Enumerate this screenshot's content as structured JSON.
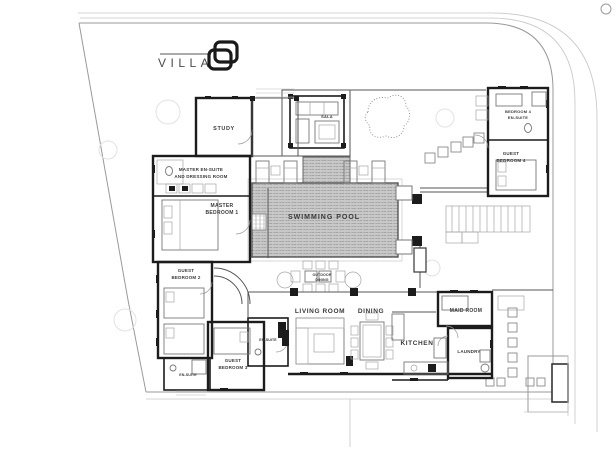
{
  "title": "Villa 8 floor plan",
  "logo": {
    "text": "VILLA",
    "number": "8"
  },
  "rooms": {
    "study": "STUDY",
    "master_ensuite": {
      "line1": "MASTER EN-SUITE",
      "line2": "AND DRESSING ROOM"
    },
    "master_bedroom": {
      "line1": "MASTER",
      "line2": "BEDROOM 1"
    },
    "guest_bedroom2": {
      "line1": "GUEST",
      "line2": "BEDROOM 2"
    },
    "guest_bedroom3": {
      "line1": "GUEST",
      "line2": "BEDROOM 3"
    },
    "guest_bedroom4": {
      "line1": "GUEST",
      "line2": "BEDROOM 4"
    },
    "bedroom4_ensuite": {
      "line1": "BEDROOM 4",
      "line2": "EN-SUITE"
    },
    "ensuite_a": "EN-SUITE",
    "ensuite_b": "EN-SUITE",
    "living_room": "LIVING ROOM",
    "dining": "DINING",
    "kitchen": "KITCHEN",
    "maid_room": "MAID ROOM",
    "laundry": "LAUNDRY"
  },
  "outdoor": {
    "swimming_pool": "SWIMMING POOL",
    "sala": "SALA",
    "outdoor_dining": {
      "line1": "OUTDOOR",
      "line2": "DINING"
    }
  },
  "colors": {
    "wall": "#1c1c1c",
    "partition": "#555555",
    "line": "#9a9a9a",
    "pool_fill": "#c8c8c8",
    "pool_texture": "#9a9a9a",
    "label": "#3a3a3a",
    "background": "#ffffff"
  }
}
